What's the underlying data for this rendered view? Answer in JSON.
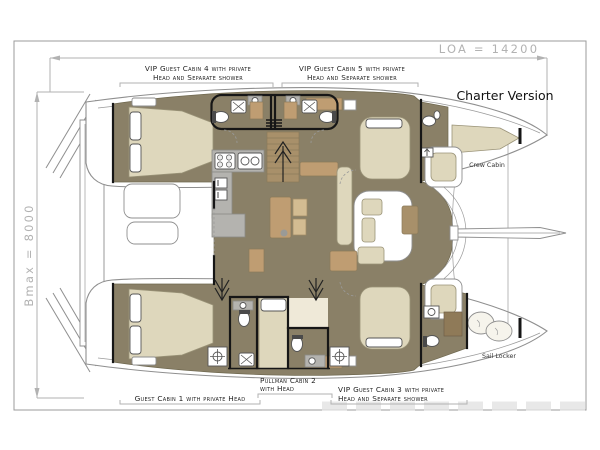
{
  "diagram": {
    "type": "catamaran-deck-plan",
    "version_label": "Charter Version",
    "dimensions": {
      "loa": "LOA = 14200",
      "bmax": "Bmax = 8000"
    },
    "cabins": {
      "vip4": {
        "line1": "VIP Guest Cabin 4 with private",
        "line2": "Head and Separate shower"
      },
      "vip5": {
        "line1": "VIP Guest Cabin 5 with private",
        "line2": "Head and Separate shower"
      },
      "guest1": {
        "label": "Guest Cabin 1 with private Head"
      },
      "pullman2": {
        "line1": "Pullman Cabin 2",
        "line2": "with Head"
      },
      "vip3": {
        "line1": "VIP Guest Cabin 3 with private",
        "line2": "Head and Separate shower"
      },
      "crew": {
        "label": "Crew Cabin"
      },
      "sail_locker": {
        "label": "Sail Locker"
      }
    },
    "colors": {
      "floor_olive": "#8a8067",
      "furniture_tan": "#bf9d72",
      "cushion_cream": "#ded7bc",
      "counter_gray": "#b4b3af",
      "outline_gray": "#8f8f8f",
      "dimension_gray": "#b2b2b2",
      "wall_black": "#161616"
    }
  }
}
